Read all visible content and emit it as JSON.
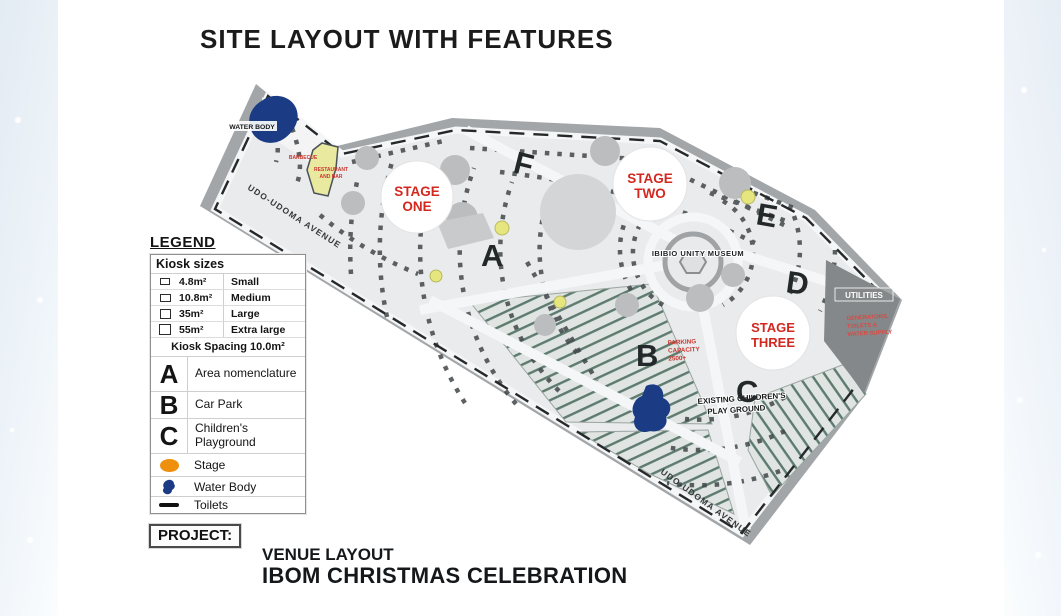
{
  "page": {
    "title": "SITE LAYOUT WITH FEATURES"
  },
  "legend": {
    "title": "LEGEND",
    "kiosk_header": "Kiosk sizes",
    "kiosk_sizes": [
      {
        "size": "4.8m²",
        "label": "Small"
      },
      {
        "size": "10.8m²",
        "label": "Medium"
      },
      {
        "size": "35m²",
        "label": "Large"
      },
      {
        "size": "55m²",
        "label": "Extra large"
      }
    ],
    "kiosk_spacing": "Kiosk Spacing 10.0m²",
    "areas": [
      {
        "symbol": "A",
        "label": "Area nomenclature"
      },
      {
        "symbol": "B",
        "label": "Car Park"
      },
      {
        "symbol": "C",
        "label": "Children's Playground"
      }
    ],
    "symbols": [
      {
        "icon": "stage-icon",
        "label": "Stage"
      },
      {
        "icon": "water-body-icon",
        "label": "Water Body"
      },
      {
        "icon": "toilets-icon",
        "label": "Toilets"
      }
    ]
  },
  "map": {
    "water_body": "WATER BODY",
    "barbecue": "BARBECUE",
    "restaurant_1": "RESTAURANT",
    "restaurant_2": "AND BAR",
    "museum": "IBIBIO UNITY MUSEUM",
    "utilities": "UTILITIES",
    "utilities_sub_1": "GENERATORS,",
    "utilities_sub_2": "TOILETS &",
    "utilities_sub_3": "WATER SUPPLY",
    "parking_1": "PARKING",
    "parking_2": "CAPACITY",
    "parking_3": "2500+",
    "play_1": "EXISTING CHILDREN'S",
    "play_2": "PLAY GROUND",
    "street_left": "UDO-UDOMA AVENUE",
    "street_bottom": "UDO-UDOMA AVENUE",
    "letters": {
      "a": "A",
      "b": "B",
      "c": "C",
      "d": "D",
      "e": "E",
      "f": "F"
    },
    "stage_one_1": "STAGE",
    "stage_one_2": "ONE",
    "stage_two_1": "STAGE",
    "stage_two_2": "TWO",
    "stage_three_1": "STAGE",
    "stage_three_2": "THREE"
  },
  "project": {
    "label": "PROJECT:",
    "line1": "VENUE LAYOUT",
    "line2": "IBOM CHRISTMAS CELEBRATION"
  },
  "colors": {
    "stage_text_red": "#d3281f",
    "note_red": "#c9372e",
    "water_blue": "#1b3c85",
    "stage_orange": "#ef8f0e",
    "zone_yellow": "#e9e9a0",
    "road_gray": "#a2a6a8"
  }
}
